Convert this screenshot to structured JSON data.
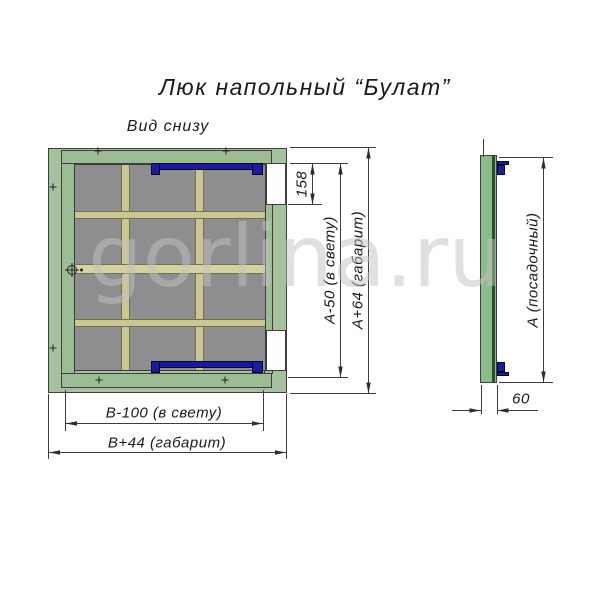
{
  "title": "Люк напольный “Булат”",
  "view_label": "Вид снизу",
  "watermark": "gorlina.ru",
  "main_view": {
    "dim_latch_offset": "158",
    "dim_height_clear": "А-50 (в свету)",
    "dim_height_overall": "А+64 (габарит)",
    "dim_width_clear": "В-100 (в свету)",
    "dim_width_overall": "В+44 (габарит)"
  },
  "side_view": {
    "dim_height_seat": "А (посадочный)",
    "dim_depth": "60"
  },
  "colors": {
    "frame_green": "#a6c19d",
    "lid_green": "#9cbc95",
    "side_green": "#8abd89",
    "panel_gray": "#8e8e90",
    "stiffener_tan": "#cbc794",
    "stiffener_mid": "#d4d1a2",
    "hinge_navy": "#1b1b9e"
  }
}
